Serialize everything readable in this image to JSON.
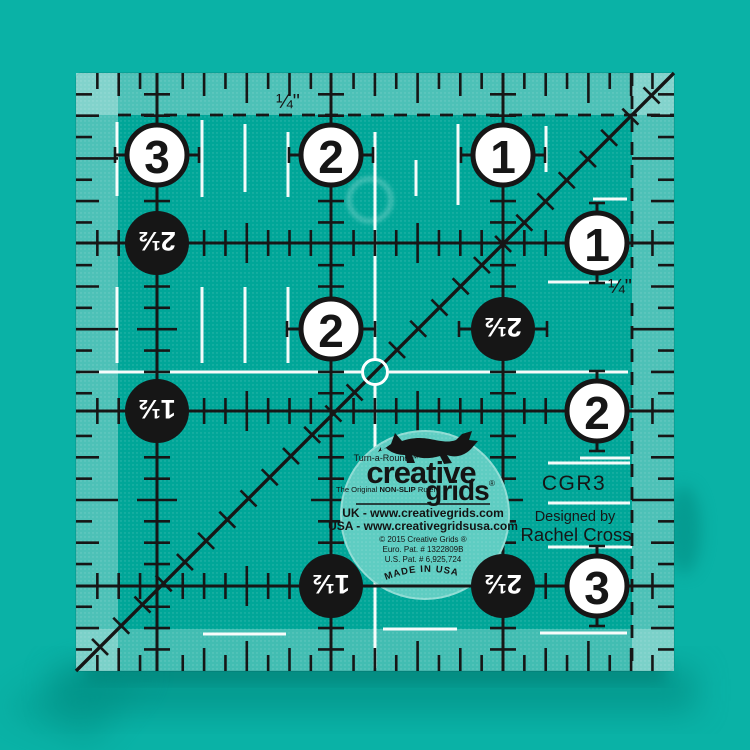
{
  "product_photo": "Creative Grids non-slip square quilting ruler on teal backdrop",
  "colors": {
    "background": "#0ab2a6",
    "ruler_body": "#00a698",
    "edge_strip": "#7fd2c9",
    "sticker": "#5fcdc2",
    "ink": "#161616",
    "accent_white": "#ffffff"
  },
  "quarter_labels": {
    "top": "¼\"",
    "right": "¼\""
  },
  "side_text": {
    "model": "CGR3",
    "designed_by": "Designed by",
    "designer": "Rachel Cross"
  },
  "sticker": {
    "turnaround": "Turn-a-Round™",
    "brand_word1": "creative",
    "brand_word2": "grids",
    "registered_mark": "®",
    "tagline_prefix": "The Original ",
    "tagline_bold": "NON-SLIP",
    "tagline_suffix": " Ruler",
    "uk_line": "UK - www.creativegrids.com",
    "usa_line": "USA - www.creativegridsusa.com",
    "copyright_line": "© 2015 Creative Grids ®",
    "euro_patent": "Euro. Pat. # 1322809B",
    "us_patent": "U.S. Pat. # 6,925,724",
    "made_in": "MADE IN USA"
  },
  "ruler": {
    "circle_markers": [
      {
        "label": "3",
        "variant": "white",
        "rotated": false,
        "x": 157,
        "y": 155
      },
      {
        "label": "2",
        "variant": "white",
        "rotated": false,
        "x": 331,
        "y": 155
      },
      {
        "label": "1",
        "variant": "white",
        "rotated": false,
        "x": 503,
        "y": 155
      },
      {
        "label": "2½",
        "variant": "black",
        "rotated": true,
        "x": 157,
        "y": 243
      },
      {
        "label": "1",
        "variant": "white",
        "rotated": false,
        "x": 597,
        "y": 243
      },
      {
        "label": "2",
        "variant": "white",
        "rotated": false,
        "x": 331,
        "y": 329
      },
      {
        "label": "2½",
        "variant": "black",
        "rotated": true,
        "x": 503,
        "y": 329
      },
      {
        "label": "1½",
        "variant": "black",
        "rotated": true,
        "x": 157,
        "y": 411
      },
      {
        "label": "2",
        "variant": "white",
        "rotated": false,
        "x": 597,
        "y": 411
      },
      {
        "label": "1½",
        "variant": "black",
        "rotated": true,
        "x": 331,
        "y": 586
      },
      {
        "label": "2½",
        "variant": "black",
        "rotated": true,
        "x": 503,
        "y": 586
      },
      {
        "label": "3",
        "variant": "white",
        "rotated": false,
        "x": 597,
        "y": 586
      }
    ]
  }
}
